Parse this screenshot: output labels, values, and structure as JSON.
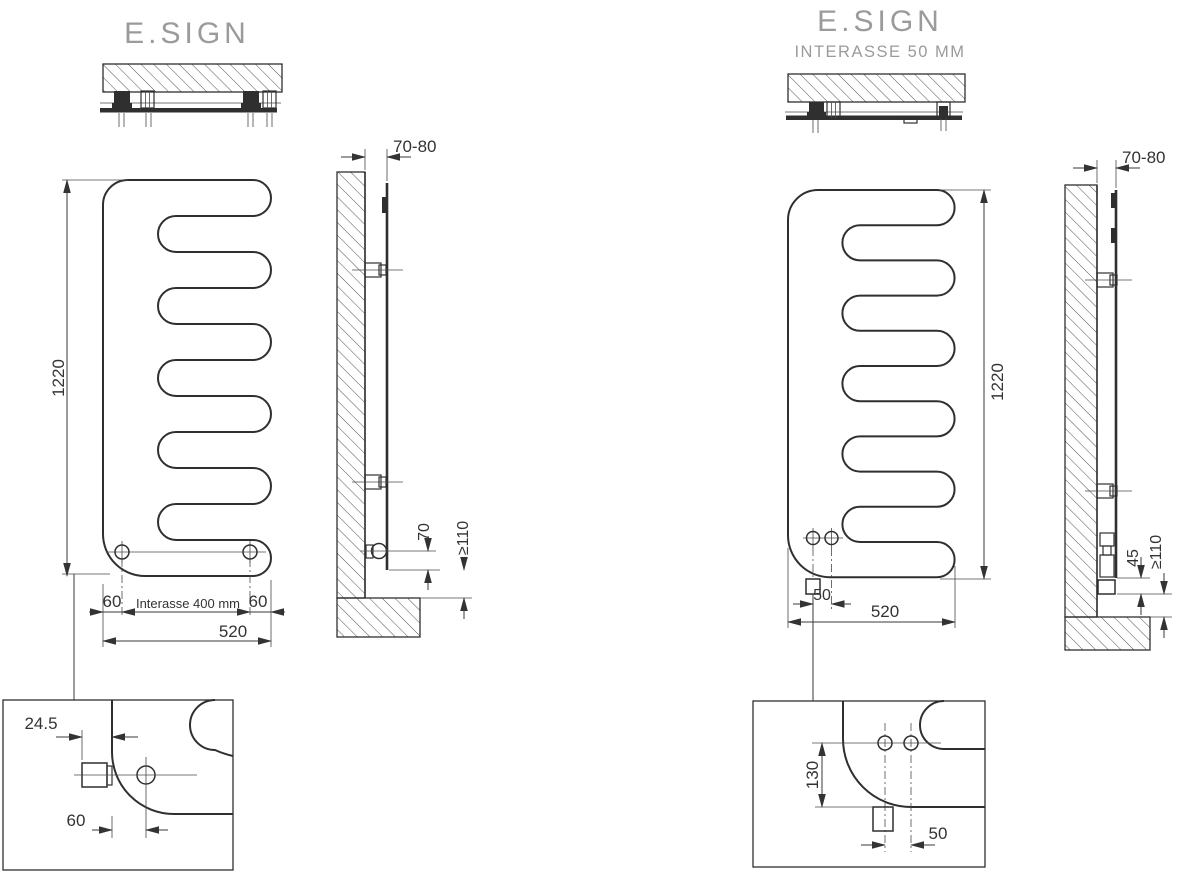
{
  "document": {
    "background": "#ffffff",
    "line_color": "#2f2f2f",
    "dimension_text_color": "#333333",
    "title_color": "#9b9b9b"
  },
  "left_drawing": {
    "title": "E.SIGN",
    "front_view": {
      "height_mm": "1220",
      "offset_left_mm": "60",
      "interasse_label": "Interasse 400 mm",
      "offset_right_mm": "60",
      "width_mm": "520"
    },
    "side_view": {
      "wall_distance_mm": "70-80",
      "outlet_height_mm": "70",
      "min_floor_clearance_mm": "≥110"
    },
    "detail_view": {
      "fitting_protrusion_mm": "24.5",
      "outlet_offset_mm": "60"
    }
  },
  "right_drawing": {
    "title": "E.SIGN",
    "subtitle": "INTERASSE 50 MM",
    "front_view": {
      "height_mm": "1220",
      "interasse_mm": "50",
      "width_mm": "520"
    },
    "side_view": {
      "wall_distance_mm": "70-80",
      "valve_drop_mm": "45",
      "min_floor_clearance_mm": "≥110"
    },
    "detail_view": {
      "outlet_height_mm": "130",
      "interasse_mm": "50"
    }
  }
}
